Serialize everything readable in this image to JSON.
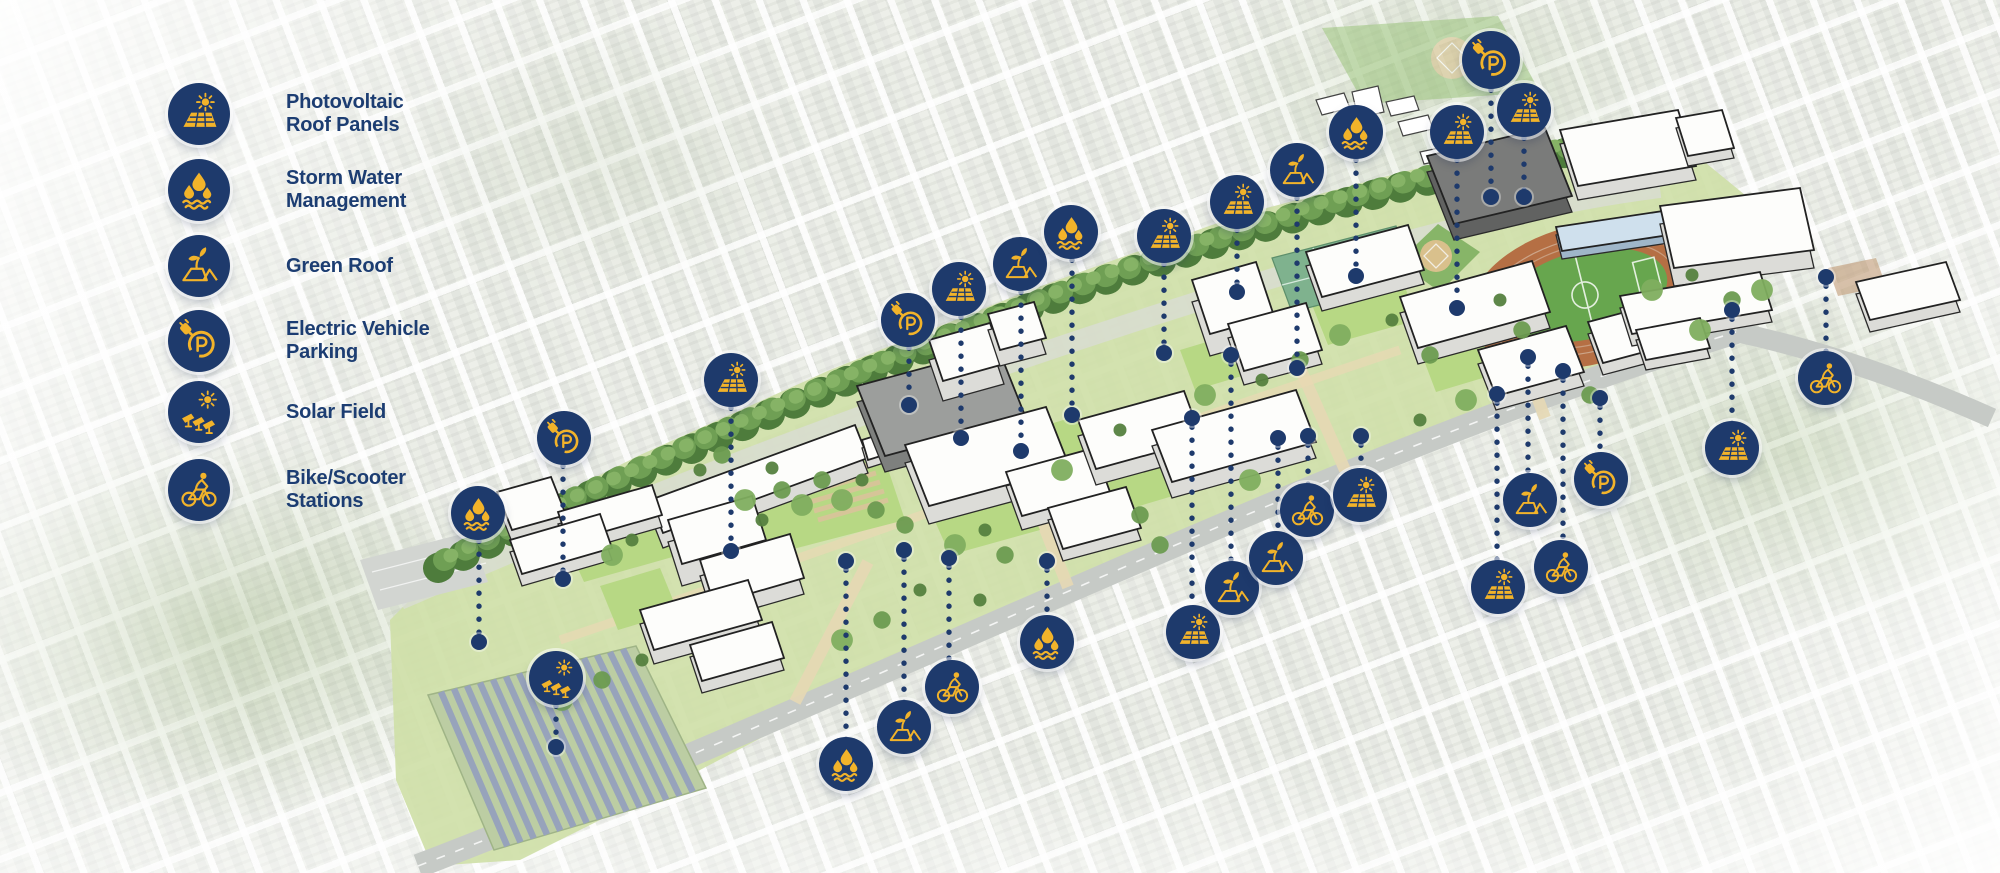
{
  "colors": {
    "icon_bg": "#1e3a6c",
    "icon_glyph": "#f2b32a",
    "label_text": "#1c3d72",
    "connector": "#1e3a6c"
  },
  "legend": {
    "items": [
      {
        "icon": "photovoltaic-icon",
        "label_lines": [
          "Photovoltaic",
          "Roof Panels"
        ]
      },
      {
        "icon": "storm-water-icon",
        "label_lines": [
          "Storm Water",
          "Management"
        ]
      },
      {
        "icon": "green-roof-icon",
        "label_lines": [
          "Green Roof"
        ]
      },
      {
        "icon": "ev-parking-icon",
        "label_lines": [
          "Electric Vehicle",
          "Parking"
        ]
      },
      {
        "icon": "solar-field-icon",
        "label_lines": [
          "Solar Field"
        ]
      },
      {
        "icon": "bike-scooter-icon",
        "label_lines": [
          "Bike/Scooter",
          "Stations"
        ]
      }
    ]
  },
  "markers": [
    {
      "type": "storm-water",
      "x": 478,
      "y": 513,
      "end_x": 479,
      "end_y": 642
    },
    {
      "type": "ev-parking",
      "x": 564,
      "y": 438,
      "end_x": 563,
      "end_y": 579
    },
    {
      "type": "photovoltaic",
      "x": 731,
      "y": 380,
      "end_x": 731,
      "end_y": 551
    },
    {
      "type": "solar-field",
      "x": 556,
      "y": 678,
      "end_x": 556,
      "end_y": 747
    },
    {
      "type": "storm-water",
      "x": 846,
      "y": 764,
      "end_x": 846,
      "end_y": 561
    },
    {
      "type": "green-roof",
      "x": 904,
      "y": 727,
      "end_x": 904,
      "end_y": 550
    },
    {
      "type": "bike-scooter",
      "x": 952,
      "y": 687,
      "end_x": 949,
      "end_y": 558
    },
    {
      "type": "ev-parking",
      "x": 908,
      "y": 320,
      "end_x": 909,
      "end_y": 405
    },
    {
      "type": "photovoltaic",
      "x": 959,
      "y": 289,
      "end_x": 961,
      "end_y": 438
    },
    {
      "type": "green-roof",
      "x": 1020,
      "y": 264,
      "end_x": 1021,
      "end_y": 451
    },
    {
      "type": "storm-water",
      "x": 1071,
      "y": 232,
      "end_x": 1072,
      "end_y": 415
    },
    {
      "type": "photovoltaic",
      "x": 1164,
      "y": 236,
      "end_x": 1164,
      "end_y": 353
    },
    {
      "type": "photovoltaic",
      "x": 1237,
      "y": 202,
      "end_x": 1237,
      "end_y": 292
    },
    {
      "type": "storm-water",
      "x": 1047,
      "y": 642,
      "end_x": 1047,
      "end_y": 561
    },
    {
      "type": "photovoltaic",
      "x": 1193,
      "y": 632,
      "end_x": 1192,
      "end_y": 418
    },
    {
      "type": "green-roof",
      "x": 1232,
      "y": 588,
      "end_x": 1231,
      "end_y": 355
    },
    {
      "type": "green-roof",
      "x": 1276,
      "y": 558,
      "end_x": 1278,
      "end_y": 438
    },
    {
      "type": "bike-scooter",
      "x": 1307,
      "y": 510,
      "end_x": 1308,
      "end_y": 436
    },
    {
      "type": "photovoltaic",
      "x": 1360,
      "y": 495,
      "end_x": 1361,
      "end_y": 436
    },
    {
      "type": "green-roof",
      "x": 1297,
      "y": 170,
      "end_x": 1297,
      "end_y": 368
    },
    {
      "type": "storm-water",
      "x": 1356,
      "y": 132,
      "end_x": 1356,
      "end_y": 276
    },
    {
      "type": "photovoltaic",
      "x": 1457,
      "y": 132,
      "end_x": 1457,
      "end_y": 308
    },
    {
      "type": "ev-parking",
      "x": 1491,
      "y": 60,
      "end_x": 1491,
      "end_y": 197
    },
    {
      "type": "photovoltaic",
      "x": 1524,
      "y": 110,
      "end_x": 1524,
      "end_y": 197
    },
    {
      "type": "photovoltaic",
      "x": 1498,
      "y": 587,
      "end_x": 1497,
      "end_y": 394
    },
    {
      "type": "green-roof",
      "x": 1530,
      "y": 500,
      "end_x": 1528,
      "end_y": 357
    },
    {
      "type": "bike-scooter",
      "x": 1561,
      "y": 567,
      "end_x": 1563,
      "end_y": 371
    },
    {
      "type": "ev-parking",
      "x": 1601,
      "y": 479,
      "end_x": 1600,
      "end_y": 398
    },
    {
      "type": "photovoltaic",
      "x": 1732,
      "y": 448,
      "end_x": 1732,
      "end_y": 310
    },
    {
      "type": "bike-scooter",
      "x": 1825,
      "y": 378,
      "end_x": 1826,
      "end_y": 277
    }
  ]
}
